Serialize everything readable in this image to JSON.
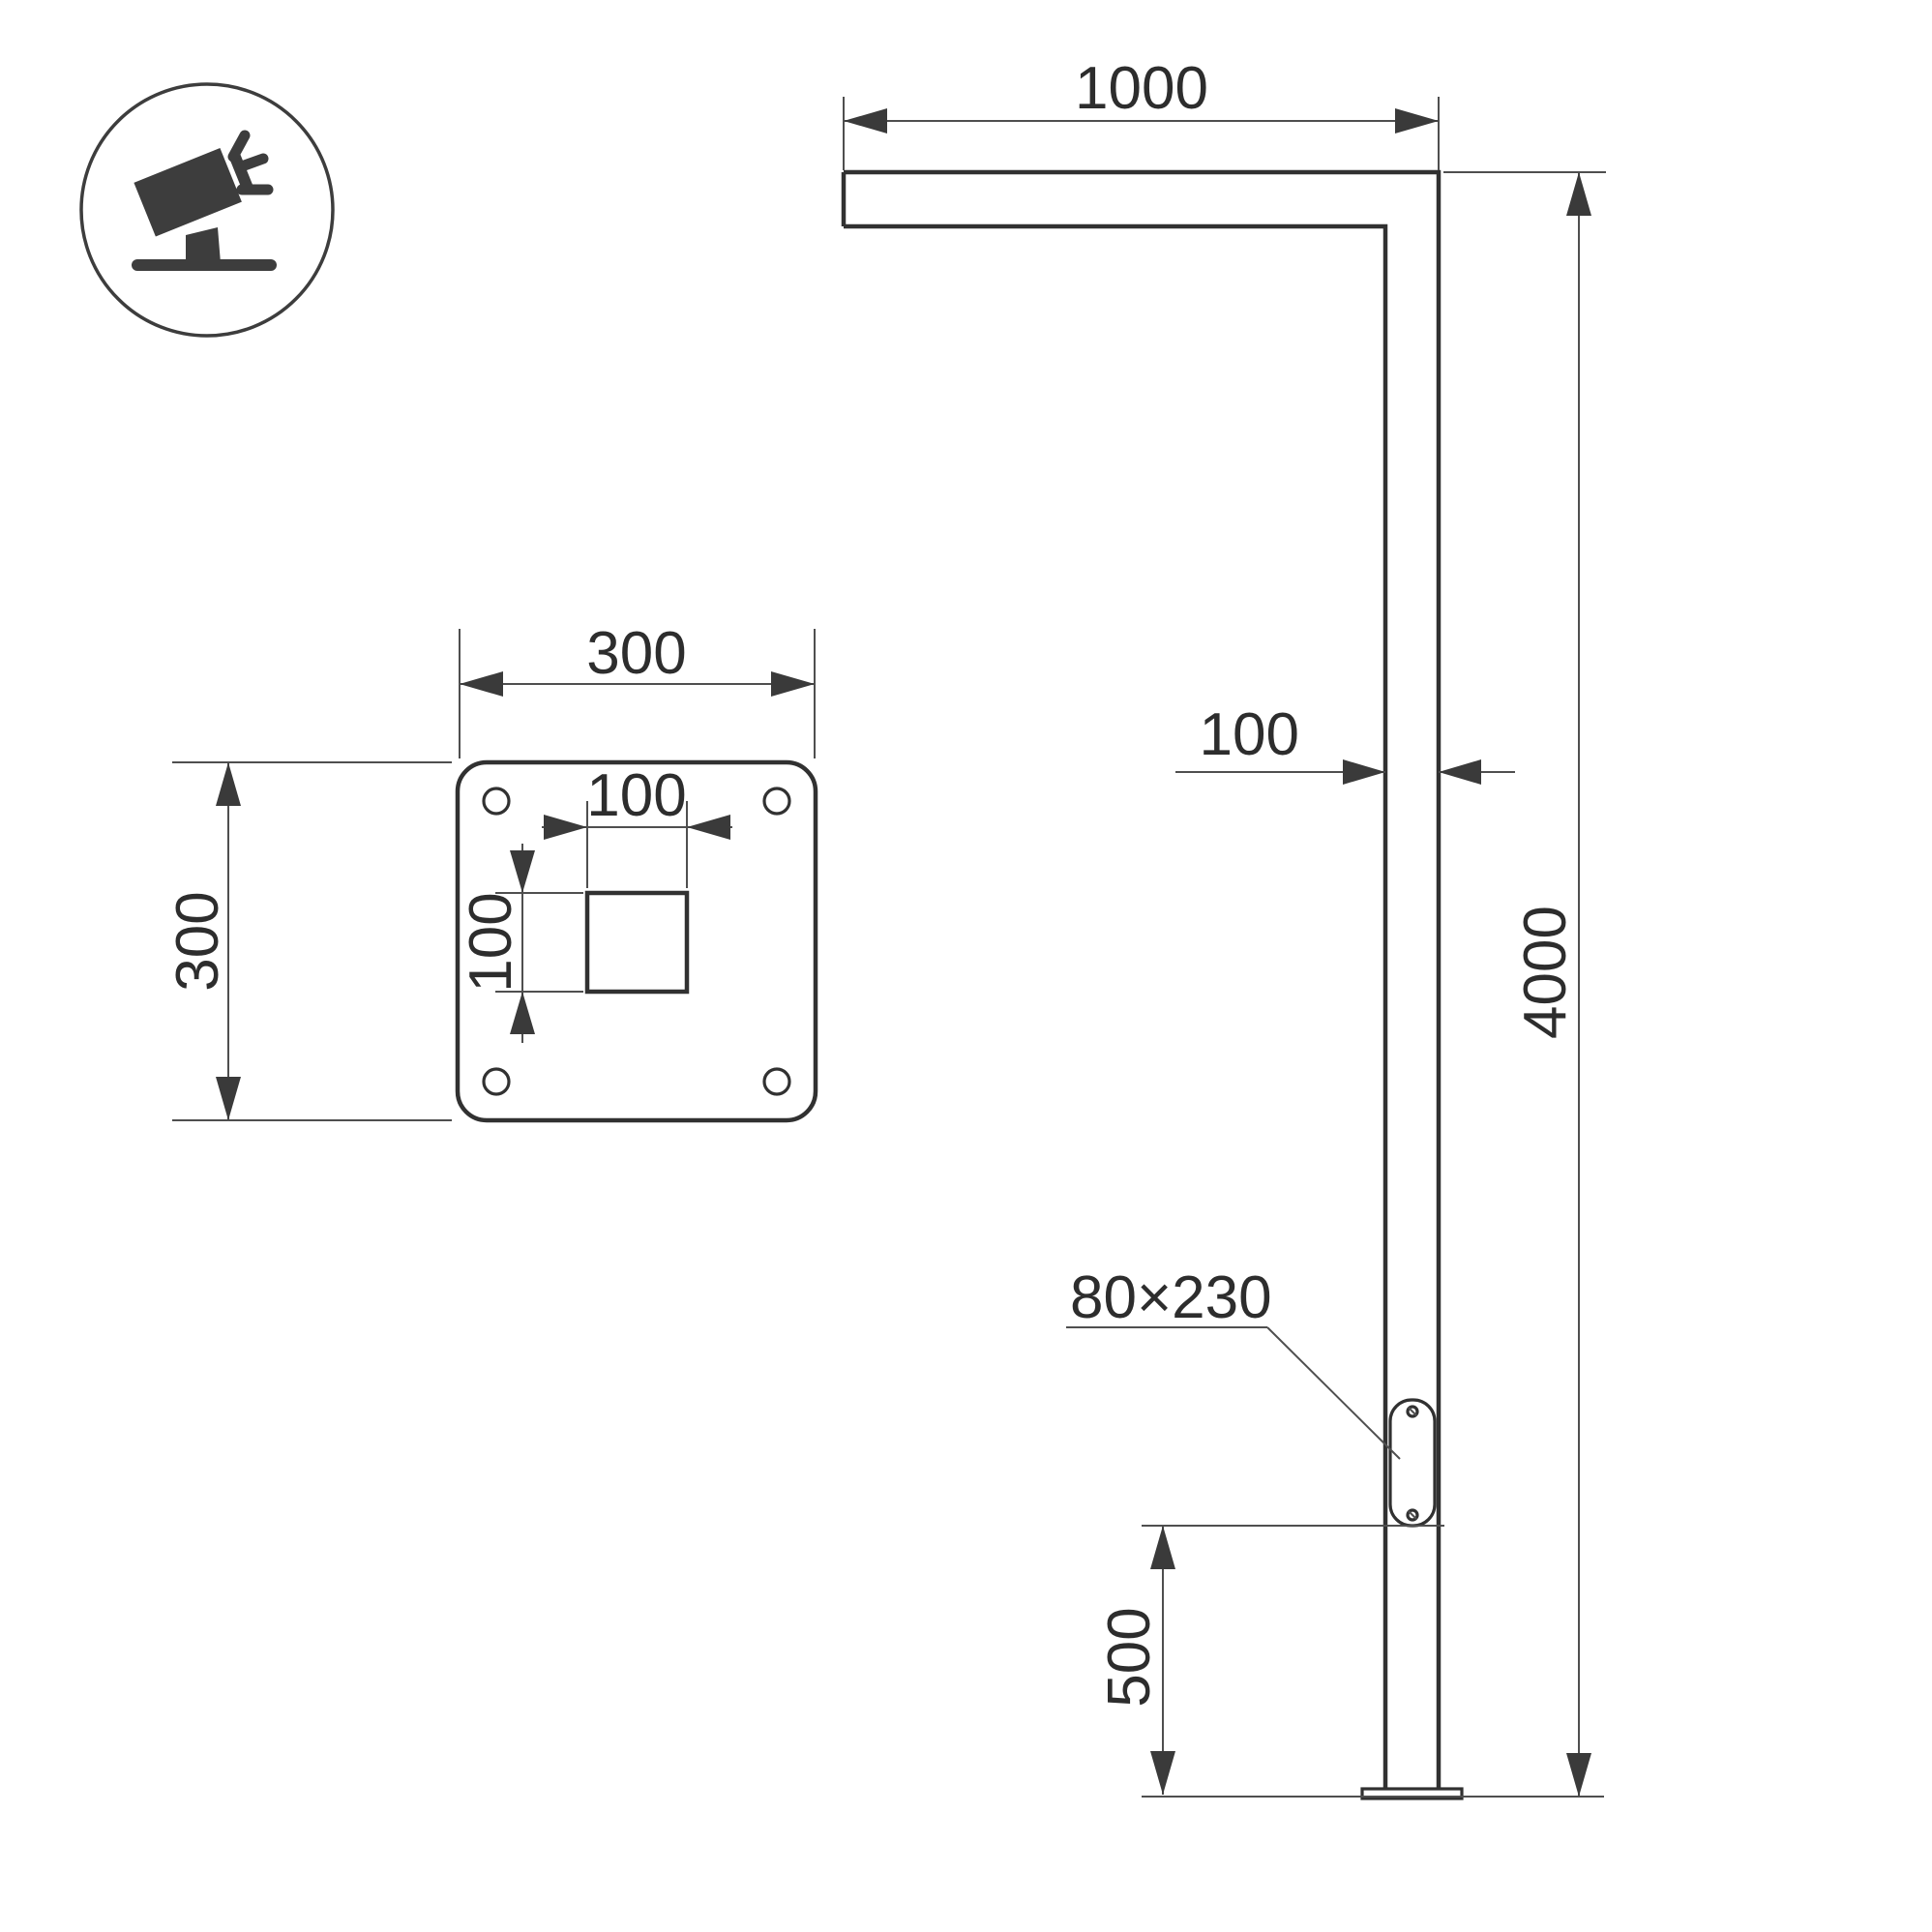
{
  "meta": {
    "title": "Street light pole dimensional drawing"
  },
  "icon": {
    "label": "tilted-floodlight-luminaire"
  },
  "dimensions": {
    "arm_length": "1000",
    "pole_width": "100",
    "pole_height": "4000",
    "door_bottom_offset": "500",
    "door_size": "80×230",
    "plate_width": "300",
    "plate_height": "300",
    "socket_width": "100",
    "socket_height": "100"
  },
  "colors": {
    "object_line": "#313131",
    "dimension_line": "#4f4f4f",
    "arrow": "#3a3a3a",
    "text": "#2d2d2d",
    "icon": "#3d3d3d",
    "background": "#ffffff"
  }
}
